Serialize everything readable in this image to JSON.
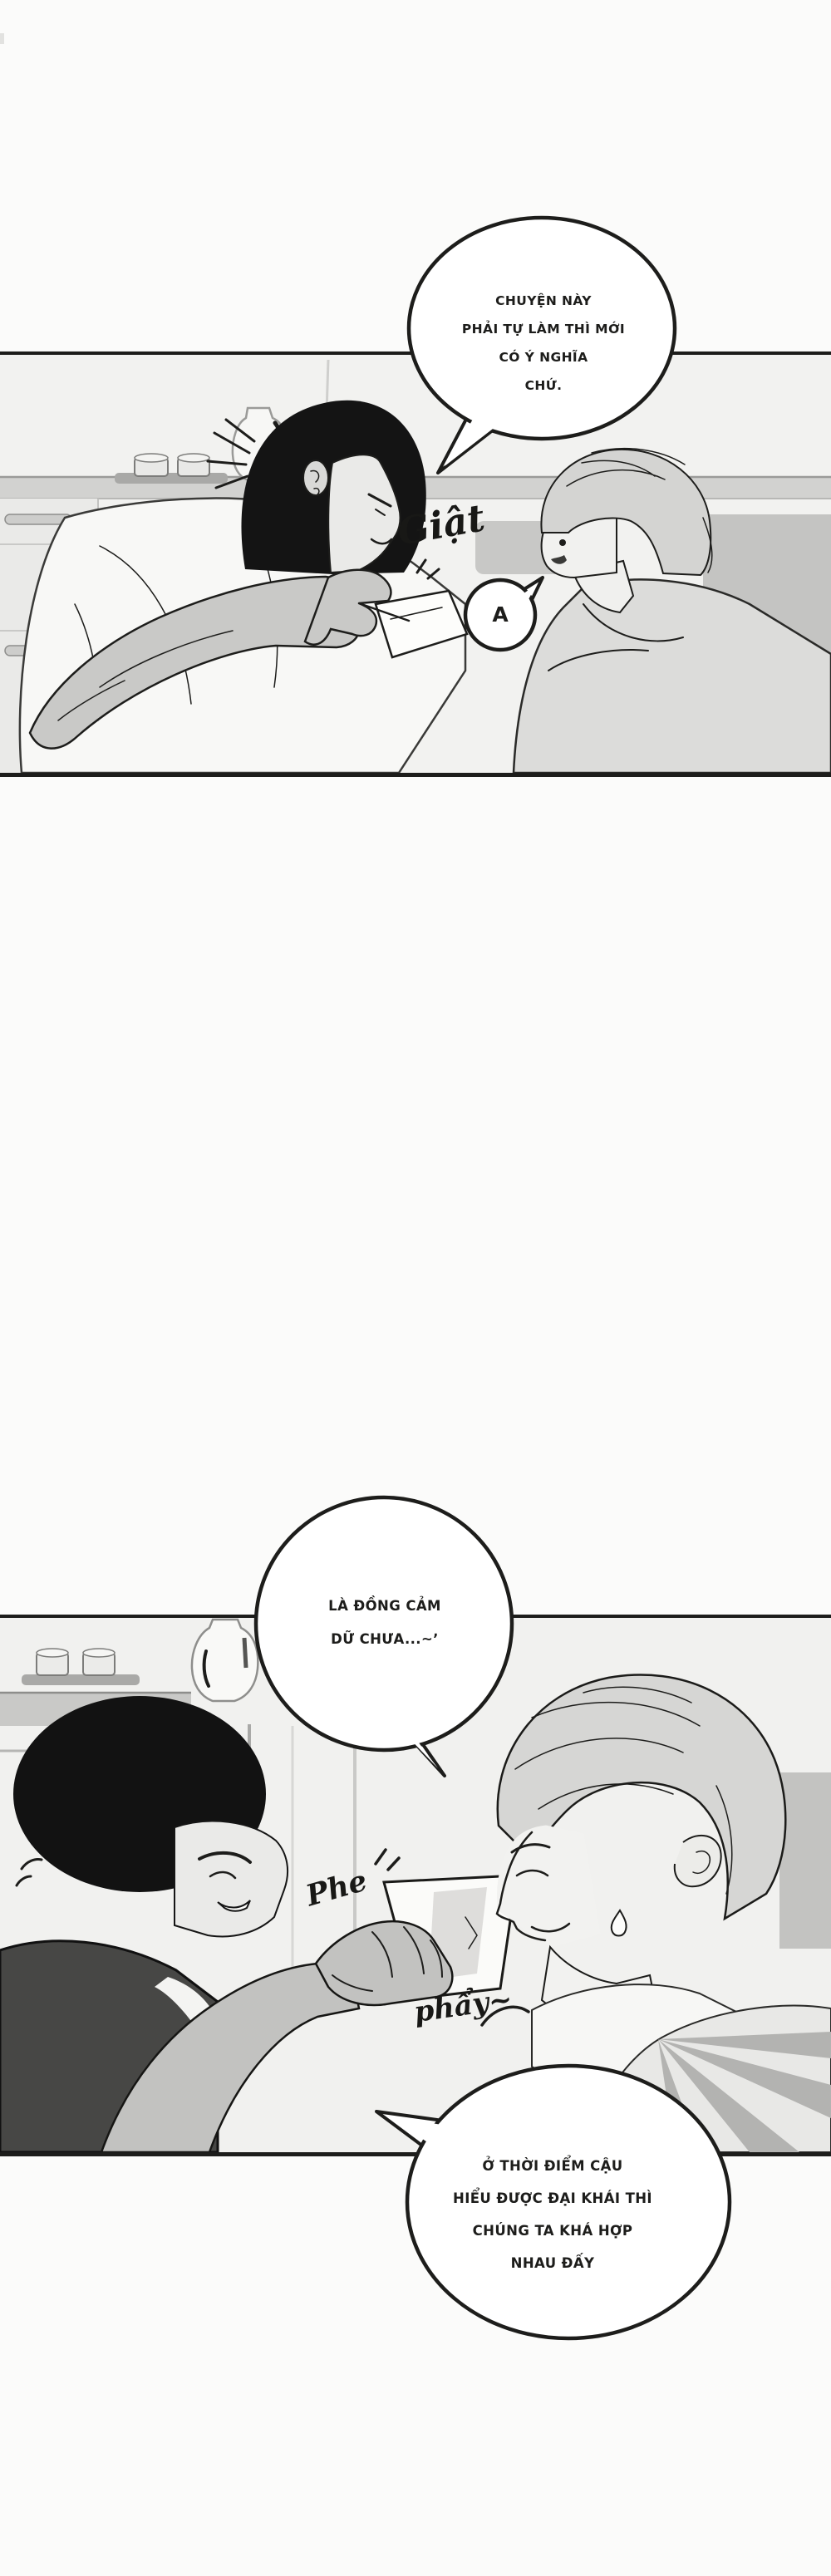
{
  "colors": {
    "paper": "#fbfbfa",
    "ink": "#1d1d1b",
    "panelBg": "#f2f2f0",
    "bubbleFill": "#ffffff",
    "sfxInk": "#181816"
  },
  "bubbles": {
    "b1": {
      "lines": [
        "CHUYỆN NÀY",
        "PHẢI TỰ LÀM THÌ MỚI",
        "CÓ Ý NGHĨA",
        "CHỨ."
      ]
    },
    "b2": {
      "lines": [
        "LÀ ĐỒNG CẢM",
        "DỮ CHƯA...~ʼ"
      ]
    },
    "b3": {
      "lines": [
        "Ở THỜI ĐIỂM CẬU",
        "HIỂU ĐƯỢC ĐẠI KHÁI THÌ",
        "CHÚNG TA KHÁ HỢP",
        "NHAU ĐẤY"
      ]
    },
    "exclaim": {
      "text": "A"
    }
  },
  "sfx": {
    "giat": "Giật",
    "phe": "Phe",
    "phay": "phẩy~"
  }
}
